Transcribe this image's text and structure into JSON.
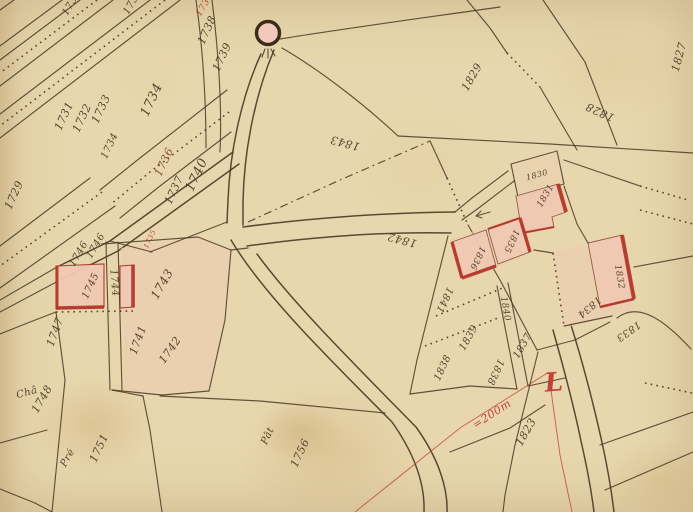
{
  "map": {
    "type": "cadastral-map",
    "colors": {
      "parchment": "#e8d7ae",
      "ink": "#4a3a24",
      "red": "#b5302a",
      "building_fill": "#f1c9b4",
      "wash": "#eccab0"
    },
    "landmark": {
      "name": "well-symbol",
      "x": 268,
      "y": 33
    },
    "annotations": {
      "scale_note": "=200m",
      "red_letter": "L"
    },
    "labels": [
      {
        "text": "1730",
        "x": 72,
        "y": 3,
        "rot": -60,
        "size": 10
      },
      {
        "text": "1733",
        "x": 133,
        "y": 2,
        "rot": -60,
        "size": 10
      },
      {
        "text": "1729",
        "x": 14,
        "y": 195,
        "rot": -65,
        "size": 11
      },
      {
        "text": "1731",
        "x": 64,
        "y": 116,
        "rot": -65,
        "size": 11
      },
      {
        "text": "1732",
        "x": 82,
        "y": 118,
        "rot": -65,
        "size": 11
      },
      {
        "text": "1733",
        "x": 101,
        "y": 109,
        "rot": -65,
        "size": 11
      },
      {
        "text": "1734",
        "x": 110,
        "y": 146,
        "rot": -65,
        "size": 10
      },
      {
        "text": "1734",
        "x": 152,
        "y": 100,
        "rot": -65,
        "size": 13
      },
      {
        "text": "1735",
        "x": 150,
        "y": 239,
        "rot": -65,
        "size": 7,
        "color": "#c04034"
      },
      {
        "text": "1736",
        "x": 164,
        "y": 162,
        "rot": -65,
        "size": 11,
        "color": "#7d4433"
      },
      {
        "text": "1737",
        "x": 174,
        "y": 190,
        "rot": -65,
        "size": 11
      },
      {
        "text": "1738",
        "x": 205,
        "y": 5,
        "rot": -60,
        "size": 9,
        "color": "#c04034"
      },
      {
        "text": "1738",
        "x": 207,
        "y": 30,
        "rot": -65,
        "size": 11
      },
      {
        "text": "1739",
        "x": 222,
        "y": 57,
        "rot": -65,
        "size": 11
      },
      {
        "text": "1740",
        "x": 197,
        "y": 175,
        "rot": -65,
        "size": 13
      },
      {
        "text": "1746",
        "x": 79,
        "y": 254,
        "rot": -60,
        "size": 10
      },
      {
        "text": "1746",
        "x": 96,
        "y": 246,
        "rot": -60,
        "size": 10
      },
      {
        "text": "1745",
        "x": 91,
        "y": 286,
        "rot": -65,
        "size": 10
      },
      {
        "text": "1744",
        "x": 114,
        "y": 283,
        "rot": 85,
        "size": 10
      },
      {
        "text": "1743",
        "x": 162,
        "y": 284,
        "rot": -60,
        "size": 12
      },
      {
        "text": "1747",
        "x": 55,
        "y": 332,
        "rot": -70,
        "size": 11
      },
      {
        "text": "1741",
        "x": 138,
        "y": 340,
        "rot": -70,
        "size": 11
      },
      {
        "text": "1742",
        "x": 170,
        "y": 350,
        "rot": -55,
        "size": 11
      },
      {
        "text": "Châ",
        "x": 27,
        "y": 393,
        "rot": -15,
        "size": 10,
        "name": "land-use-label"
      },
      {
        "text": "1748",
        "x": 42,
        "y": 399,
        "rot": -60,
        "size": 11
      },
      {
        "text": "Pré",
        "x": 68,
        "y": 458,
        "rot": -60,
        "size": 10,
        "name": "land-use-label"
      },
      {
        "text": "1751",
        "x": 99,
        "y": 448,
        "rot": -65,
        "size": 11
      },
      {
        "text": "Pât",
        "x": 268,
        "y": 436,
        "rot": -65,
        "size": 10,
        "name": "land-use-label"
      },
      {
        "text": "1756",
        "x": 300,
        "y": 453,
        "rot": -65,
        "size": 11
      },
      {
        "text": "1843",
        "x": 345,
        "y": 143,
        "rot": 195,
        "size": 11
      },
      {
        "text": "1842",
        "x": 402,
        "y": 240,
        "rot": 195,
        "size": 11
      },
      {
        "text": "1829",
        "x": 472,
        "y": 77,
        "rot": -60,
        "size": 11
      },
      {
        "text": "1828",
        "x": 600,
        "y": 112,
        "rot": 205,
        "size": 11
      },
      {
        "text": "1827",
        "x": 679,
        "y": 57,
        "rot": -75,
        "size": 11
      },
      {
        "text": "1830",
        "x": 537,
        "y": 175,
        "rot": -15,
        "size": 8
      },
      {
        "text": "1831",
        "x": 546,
        "y": 196,
        "rot": -60,
        "size": 9
      },
      {
        "text": "1835",
        "x": 511,
        "y": 241,
        "rot": 115,
        "size": 9
      },
      {
        "text": "1836",
        "x": 477,
        "y": 258,
        "rot": 115,
        "size": 9
      },
      {
        "text": "1832",
        "x": 619,
        "y": 277,
        "rot": 80,
        "size": 9
      },
      {
        "text": "1834",
        "x": 589,
        "y": 307,
        "rot": 140,
        "size": 10
      },
      {
        "text": "1833",
        "x": 628,
        "y": 331,
        "rot": 145,
        "size": 10
      },
      {
        "text": "1841",
        "x": 444,
        "y": 300,
        "rot": 115,
        "size": 10
      },
      {
        "text": "1840",
        "x": 505,
        "y": 309,
        "rot": 80,
        "size": 9
      },
      {
        "text": "1839",
        "x": 469,
        "y": 338,
        "rot": -60,
        "size": 10
      },
      {
        "text": "1837",
        "x": 523,
        "y": 346,
        "rot": -60,
        "size": 10
      },
      {
        "text": "1838",
        "x": 443,
        "y": 368,
        "rot": -65,
        "size": 10
      },
      {
        "text": "1838",
        "x": 495,
        "y": 372,
        "rot": 115,
        "size": 10
      },
      {
        "text": "1823",
        "x": 526,
        "y": 432,
        "rot": -60,
        "size": 11
      },
      {
        "text": "=200m",
        "x": 492,
        "y": 414,
        "rot": -33,
        "size": 11,
        "color": "#c0392e",
        "name": "scale-note"
      },
      {
        "text": "L",
        "x": 554,
        "y": 383,
        "rot": -5,
        "size": 26,
        "color": "#c0392e",
        "name": "red-letter-L"
      }
    ]
  }
}
